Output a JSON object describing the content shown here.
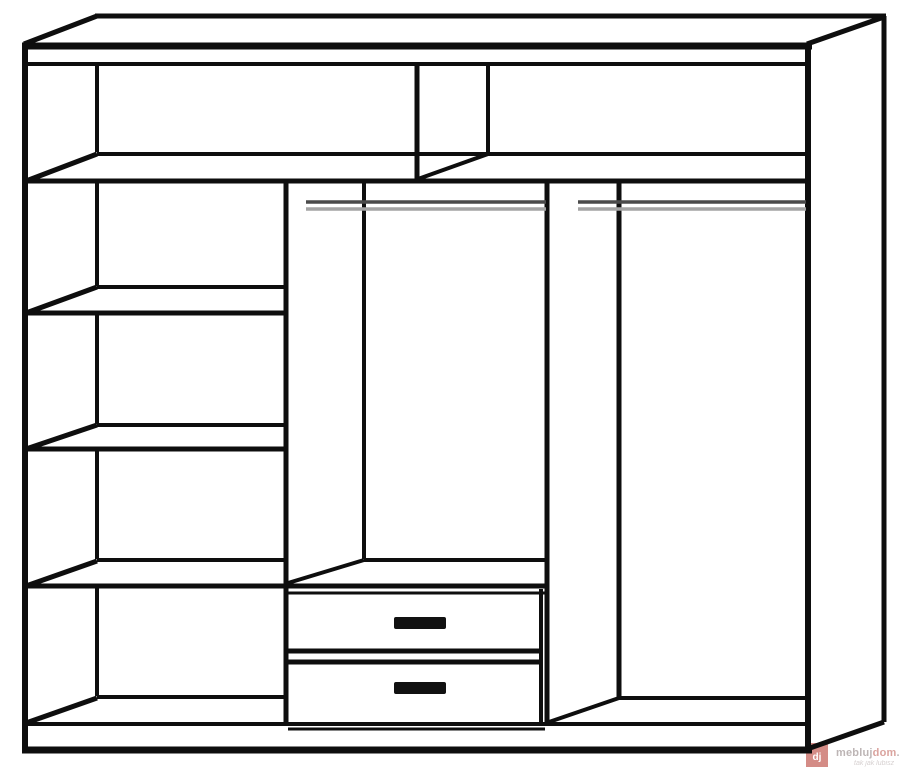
{
  "page": {
    "background": "#ffffff",
    "width": 900,
    "height": 769
  },
  "diagram": {
    "title": "wardrobe-interior-line-drawing",
    "colors": {
      "line": "#0e0e0e",
      "rail_dark": "#4a4a4a",
      "rail_light": "#a3a3a3",
      "handle": "#111111",
      "background": "#ffffff"
    },
    "segments": [
      {
        "name": "top-back-edge",
        "x1": 95,
        "y1": 16,
        "x2": 886,
        "y2": 16,
        "w": 5
      },
      {
        "name": "top-left-depth-diagonal",
        "x1": 24,
        "y1": 44,
        "x2": 97,
        "y2": 16,
        "w": 5
      },
      {
        "name": "top-right-depth-diagonal",
        "x1": 807,
        "y1": 44,
        "x2": 884,
        "y2": 17,
        "w": 5
      },
      {
        "name": "top-front-edge",
        "x1": 22,
        "y1": 46,
        "x2": 812,
        "y2": 46,
        "w": 7
      },
      {
        "name": "top-panel-underside",
        "x1": 24,
        "y1": 64,
        "x2": 806,
        "y2": 64,
        "w": 4
      },
      {
        "name": "left-front-edge",
        "x1": 25,
        "y1": 44,
        "x2": 25,
        "y2": 751,
        "w": 6
      },
      {
        "name": "right-front-edge",
        "x1": 808,
        "y1": 44,
        "x2": 808,
        "y2": 751,
        "w": 6
      },
      {
        "name": "right-back-edge",
        "x1": 884,
        "y1": 16,
        "x2": 884,
        "y2": 722,
        "w": 5
      },
      {
        "name": "bottom-front-edge",
        "x1": 22,
        "y1": 750,
        "x2": 812,
        "y2": 750,
        "w": 7
      },
      {
        "name": "bottom-right-depth-diagonal",
        "x1": 810,
        "y1": 748,
        "x2": 884,
        "y2": 722,
        "w": 5
      },
      {
        "name": "floor-front-edge",
        "x1": 25,
        "y1": 724,
        "x2": 806,
        "y2": 724,
        "w": 4
      },
      {
        "name": "back-left-corner-top-section",
        "x1": 97,
        "y1": 66,
        "x2": 97,
        "y2": 152,
        "w": 4
      },
      {
        "name": "top-shelf-back-edge",
        "x1": 97,
        "y1": 154,
        "x2": 806,
        "y2": 154,
        "w": 4
      },
      {
        "name": "top-shelf-front-edge",
        "x1": 24,
        "y1": 181,
        "x2": 806,
        "y2": 181,
        "w": 5
      },
      {
        "name": "top-shelf-left-diagonal",
        "x1": 26,
        "y1": 181,
        "x2": 97,
        "y2": 154,
        "w": 5
      },
      {
        "name": "top-divider-front-edge",
        "x1": 417,
        "y1": 64,
        "x2": 417,
        "y2": 180,
        "w": 5
      },
      {
        "name": "top-divider-back-edge",
        "x1": 488,
        "y1": 64,
        "x2": 488,
        "y2": 154,
        "w": 4
      },
      {
        "name": "top-divider-bottom-diagonal",
        "x1": 418,
        "y1": 179,
        "x2": 488,
        "y2": 154,
        "w": 4
      },
      {
        "name": "back-left-corner-1",
        "x1": 97,
        "y1": 183,
        "x2": 97,
        "y2": 286,
        "w": 4
      },
      {
        "name": "shelf-2-back-edge",
        "x1": 97,
        "y1": 287,
        "x2": 287,
        "y2": 287,
        "w": 4
      },
      {
        "name": "shelf-2-front-edge",
        "x1": 24,
        "y1": 313,
        "x2": 284,
        "y2": 313,
        "w": 5
      },
      {
        "name": "shelf-2-left-diagonal",
        "x1": 26,
        "y1": 313,
        "x2": 97,
        "y2": 287,
        "w": 5
      },
      {
        "name": "back-left-corner-2",
        "x1": 97,
        "y1": 315,
        "x2": 97,
        "y2": 424,
        "w": 4
      },
      {
        "name": "shelf-3-back-edge",
        "x1": 97,
        "y1": 425,
        "x2": 287,
        "y2": 425,
        "w": 4
      },
      {
        "name": "shelf-3-front-edge",
        "x1": 24,
        "y1": 449,
        "x2": 284,
        "y2": 449,
        "w": 5
      },
      {
        "name": "shelf-3-left-diagonal",
        "x1": 26,
        "y1": 449,
        "x2": 97,
        "y2": 425,
        "w": 5
      },
      {
        "name": "back-left-corner-3",
        "x1": 97,
        "y1": 451,
        "x2": 97,
        "y2": 559,
        "w": 4
      },
      {
        "name": "shelf-4-back-edge",
        "x1": 97,
        "y1": 560,
        "x2": 287,
        "y2": 560,
        "w": 4
      },
      {
        "name": "shelf-4-front-edge",
        "x1": 24,
        "y1": 586,
        "x2": 545,
        "y2": 586,
        "w": 5
      },
      {
        "name": "shelf-4-left-diagonal",
        "x1": 26,
        "y1": 586,
        "x2": 97,
        "y2": 561,
        "w": 5
      },
      {
        "name": "back-left-corner-4",
        "x1": 97,
        "y1": 588,
        "x2": 97,
        "y2": 696,
        "w": 4
      },
      {
        "name": "bottom-shelf-back-edge",
        "x1": 97,
        "y1": 697,
        "x2": 287,
        "y2": 697,
        "w": 4
      },
      {
        "name": "bottom-shelf-left-diagonal",
        "x1": 26,
        "y1": 723,
        "x2": 97,
        "y2": 698,
        "w": 5
      },
      {
        "name": "partition-1-front-edge",
        "x1": 286,
        "y1": 183,
        "x2": 286,
        "y2": 723,
        "w": 5
      },
      {
        "name": "partition-1-back-edge",
        "x1": 364,
        "y1": 183,
        "x2": 364,
        "y2": 559,
        "w": 4
      },
      {
        "name": "partition-1-bottom-diagonal",
        "x1": 288,
        "y1": 583,
        "x2": 364,
        "y2": 560,
        "w": 4
      },
      {
        "name": "drawer-unit-top-back-edge",
        "x1": 364,
        "y1": 560,
        "x2": 546,
        "y2": 560,
        "w": 4
      },
      {
        "name": "partition-2-front-edge",
        "x1": 547,
        "y1": 183,
        "x2": 547,
        "y2": 723,
        "w": 5
      },
      {
        "name": "partition-2-back-edge",
        "x1": 619,
        "y1": 183,
        "x2": 619,
        "y2": 698,
        "w": 5
      },
      {
        "name": "partition-2-bottom-diagonal",
        "x1": 549,
        "y1": 722,
        "x2": 619,
        "y2": 698,
        "w": 4
      },
      {
        "name": "right-floor-back-edge",
        "x1": 619,
        "y1": 698,
        "x2": 806,
        "y2": 698,
        "w": 4
      },
      {
        "name": "drawer-unit-top-edge",
        "x1": 286,
        "y1": 593,
        "x2": 545,
        "y2": 593,
        "w": 3
      },
      {
        "name": "drawer-right-edge",
        "x1": 541,
        "y1": 589,
        "x2": 541,
        "y2": 722,
        "w": 4
      },
      {
        "name": "drawer-separator-upper",
        "x1": 288,
        "y1": 651,
        "x2": 540,
        "y2": 651,
        "w": 5
      },
      {
        "name": "drawer-separator-lower",
        "x1": 288,
        "y1": 662,
        "x2": 540,
        "y2": 662,
        "w": 5
      },
      {
        "name": "drawer-plinth-line",
        "x1": 288,
        "y1": 729,
        "x2": 545,
        "y2": 729,
        "w": 3
      }
    ],
    "rails": [
      {
        "name": "hanging-rail-middle",
        "x1": 306,
        "x2": 546,
        "y_dark": 202,
        "y_light": 209,
        "w": 3.5
      },
      {
        "name": "hanging-rail-right",
        "x1": 578,
        "x2": 806,
        "y_dark": 202,
        "y_light": 209,
        "w": 3.5
      }
    ],
    "handles": [
      {
        "name": "drawer-handle-1",
        "x": 394,
        "y": 617,
        "w": 52,
        "h": 12
      },
      {
        "name": "drawer-handle-2",
        "x": 394,
        "y": 682,
        "w": 52,
        "h": 12
      }
    ]
  },
  "watermark": {
    "brand": "meblujdom.pl",
    "brand_parts": [
      "mebluj",
      "dom",
      ".pl"
    ],
    "tagline": "tak jak lubisz",
    "logo_text": "dj",
    "logo_color": "#c96f68",
    "logo_text_color": "#ffffff",
    "brand_gray": "#b6aeae",
    "brand_red": "#d69a94",
    "tagline_color": "#c9c1c1"
  }
}
